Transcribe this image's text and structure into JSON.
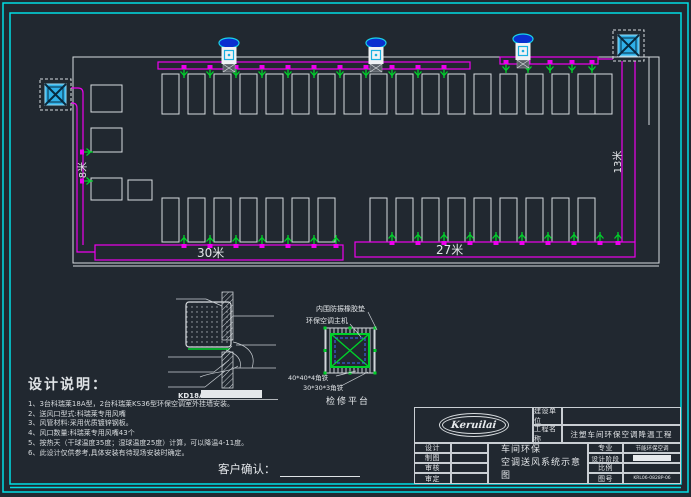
{
  "colors": {
    "background": "#212830",
    "frame_cyan": "#00dde4",
    "duct_magenta": "#ee00ee",
    "vent_green": "#00d02a",
    "line_white": "#dfe3e6",
    "unit_cyan": "#2fb0e8",
    "unit_blue": "#0a2fd0"
  },
  "plan": {
    "dimensions": {
      "left_duct_run": "8米",
      "right_duct_run": "13米",
      "bottom_left_duct": "30米",
      "bottom_right_duct": "27米"
    }
  },
  "detail_section": {
    "code_label": "KD18A"
  },
  "detail_platform": {
    "pad_label": "内围防振橡胶垫",
    "unit_label": "环保空调主机",
    "angle40_label": "40*40*4角铁",
    "angle30_label": "30*30*3角铁",
    "platform_label": "检修平台"
  },
  "design_notes": {
    "heading": "设计说明：",
    "items": [
      "1、3台科瑞莱18A型，2台科瑞莱KS36型环保空调室外挂墙安装。",
      "2、送风口型式:科瑞莱专用风嘴",
      "3、风管材料:采用优质镀锌钢板。",
      "4、风口数量:科瑞莱专用风嘴43个",
      "5、按热天（干球温度35度；湿球温度25度）计算，可以降温4-11度。",
      "6、此设计仅供参考,具体安装有待现场安装时确定。"
    ]
  },
  "customer_confirm": {
    "label": "客户确认："
  },
  "title_block": {
    "logo_text": "Keruilai",
    "construction_unit_label": "建设单位",
    "construction_unit_value": "",
    "project_name_label": "工程名称",
    "project_name_value": "注塑车间环保空调降温工程",
    "sign_rows": [
      {
        "label": "设计",
        "value": ""
      },
      {
        "label": "制图",
        "value": ""
      },
      {
        "label": "审核",
        "value": ""
      },
      {
        "label": "审定",
        "value": ""
      }
    ],
    "drawing_title_line1": "车间环保",
    "drawing_title_line2": "空调送风系统示意图",
    "info_rows": [
      {
        "label": "专业",
        "value": "节能环保空调"
      },
      {
        "label": "设计阶段",
        "value": ""
      },
      {
        "label": "比例",
        "value": ""
      },
      {
        "label": "图号",
        "value": "KRL06-0828P-06"
      }
    ]
  }
}
